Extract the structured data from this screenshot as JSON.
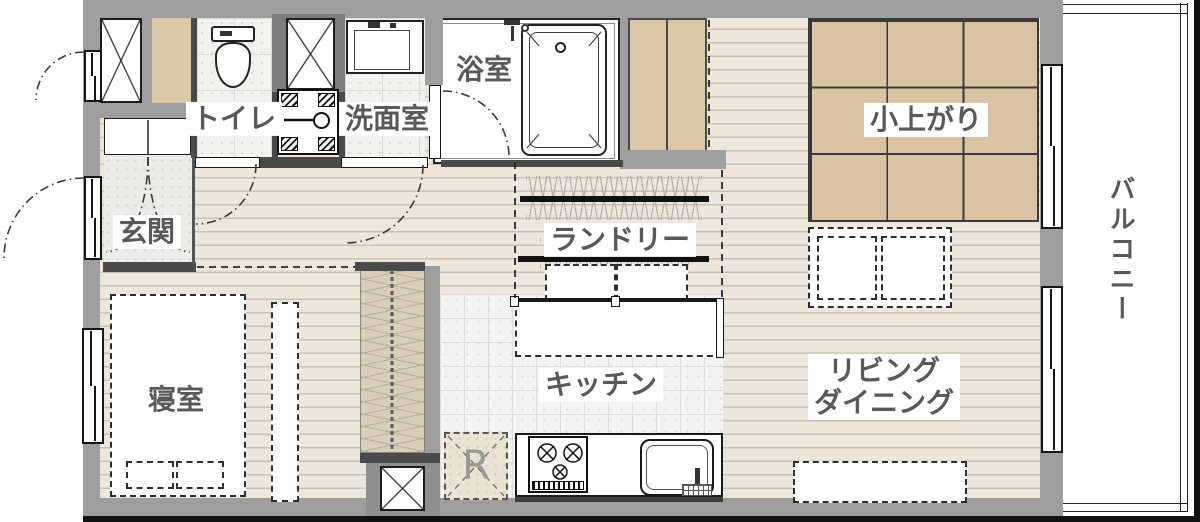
{
  "plan_title": "1LDK floor plan",
  "rooms": {
    "genkan": "玄関",
    "toilet": "トイレ",
    "washroom": "洗面室",
    "bath": "浴室",
    "laundry": "ランドリー",
    "koagari": "小上がり",
    "bedroom": "寝室",
    "kitchen": "キッチン",
    "living_line1": "リビング",
    "living_line2": "ダイニング",
    "balcony": "バルコニー",
    "fridge_mark": "R"
  },
  "colors": {
    "exterior_wall": "#9e9e9e",
    "interior_wall": "#4a4a4a",
    "wood_floor": "#ece6db",
    "plank_line": "#c9c3b7",
    "tatami": "#d9c3a2",
    "tile": "#f1f1ee",
    "label_text": "#595959"
  }
}
